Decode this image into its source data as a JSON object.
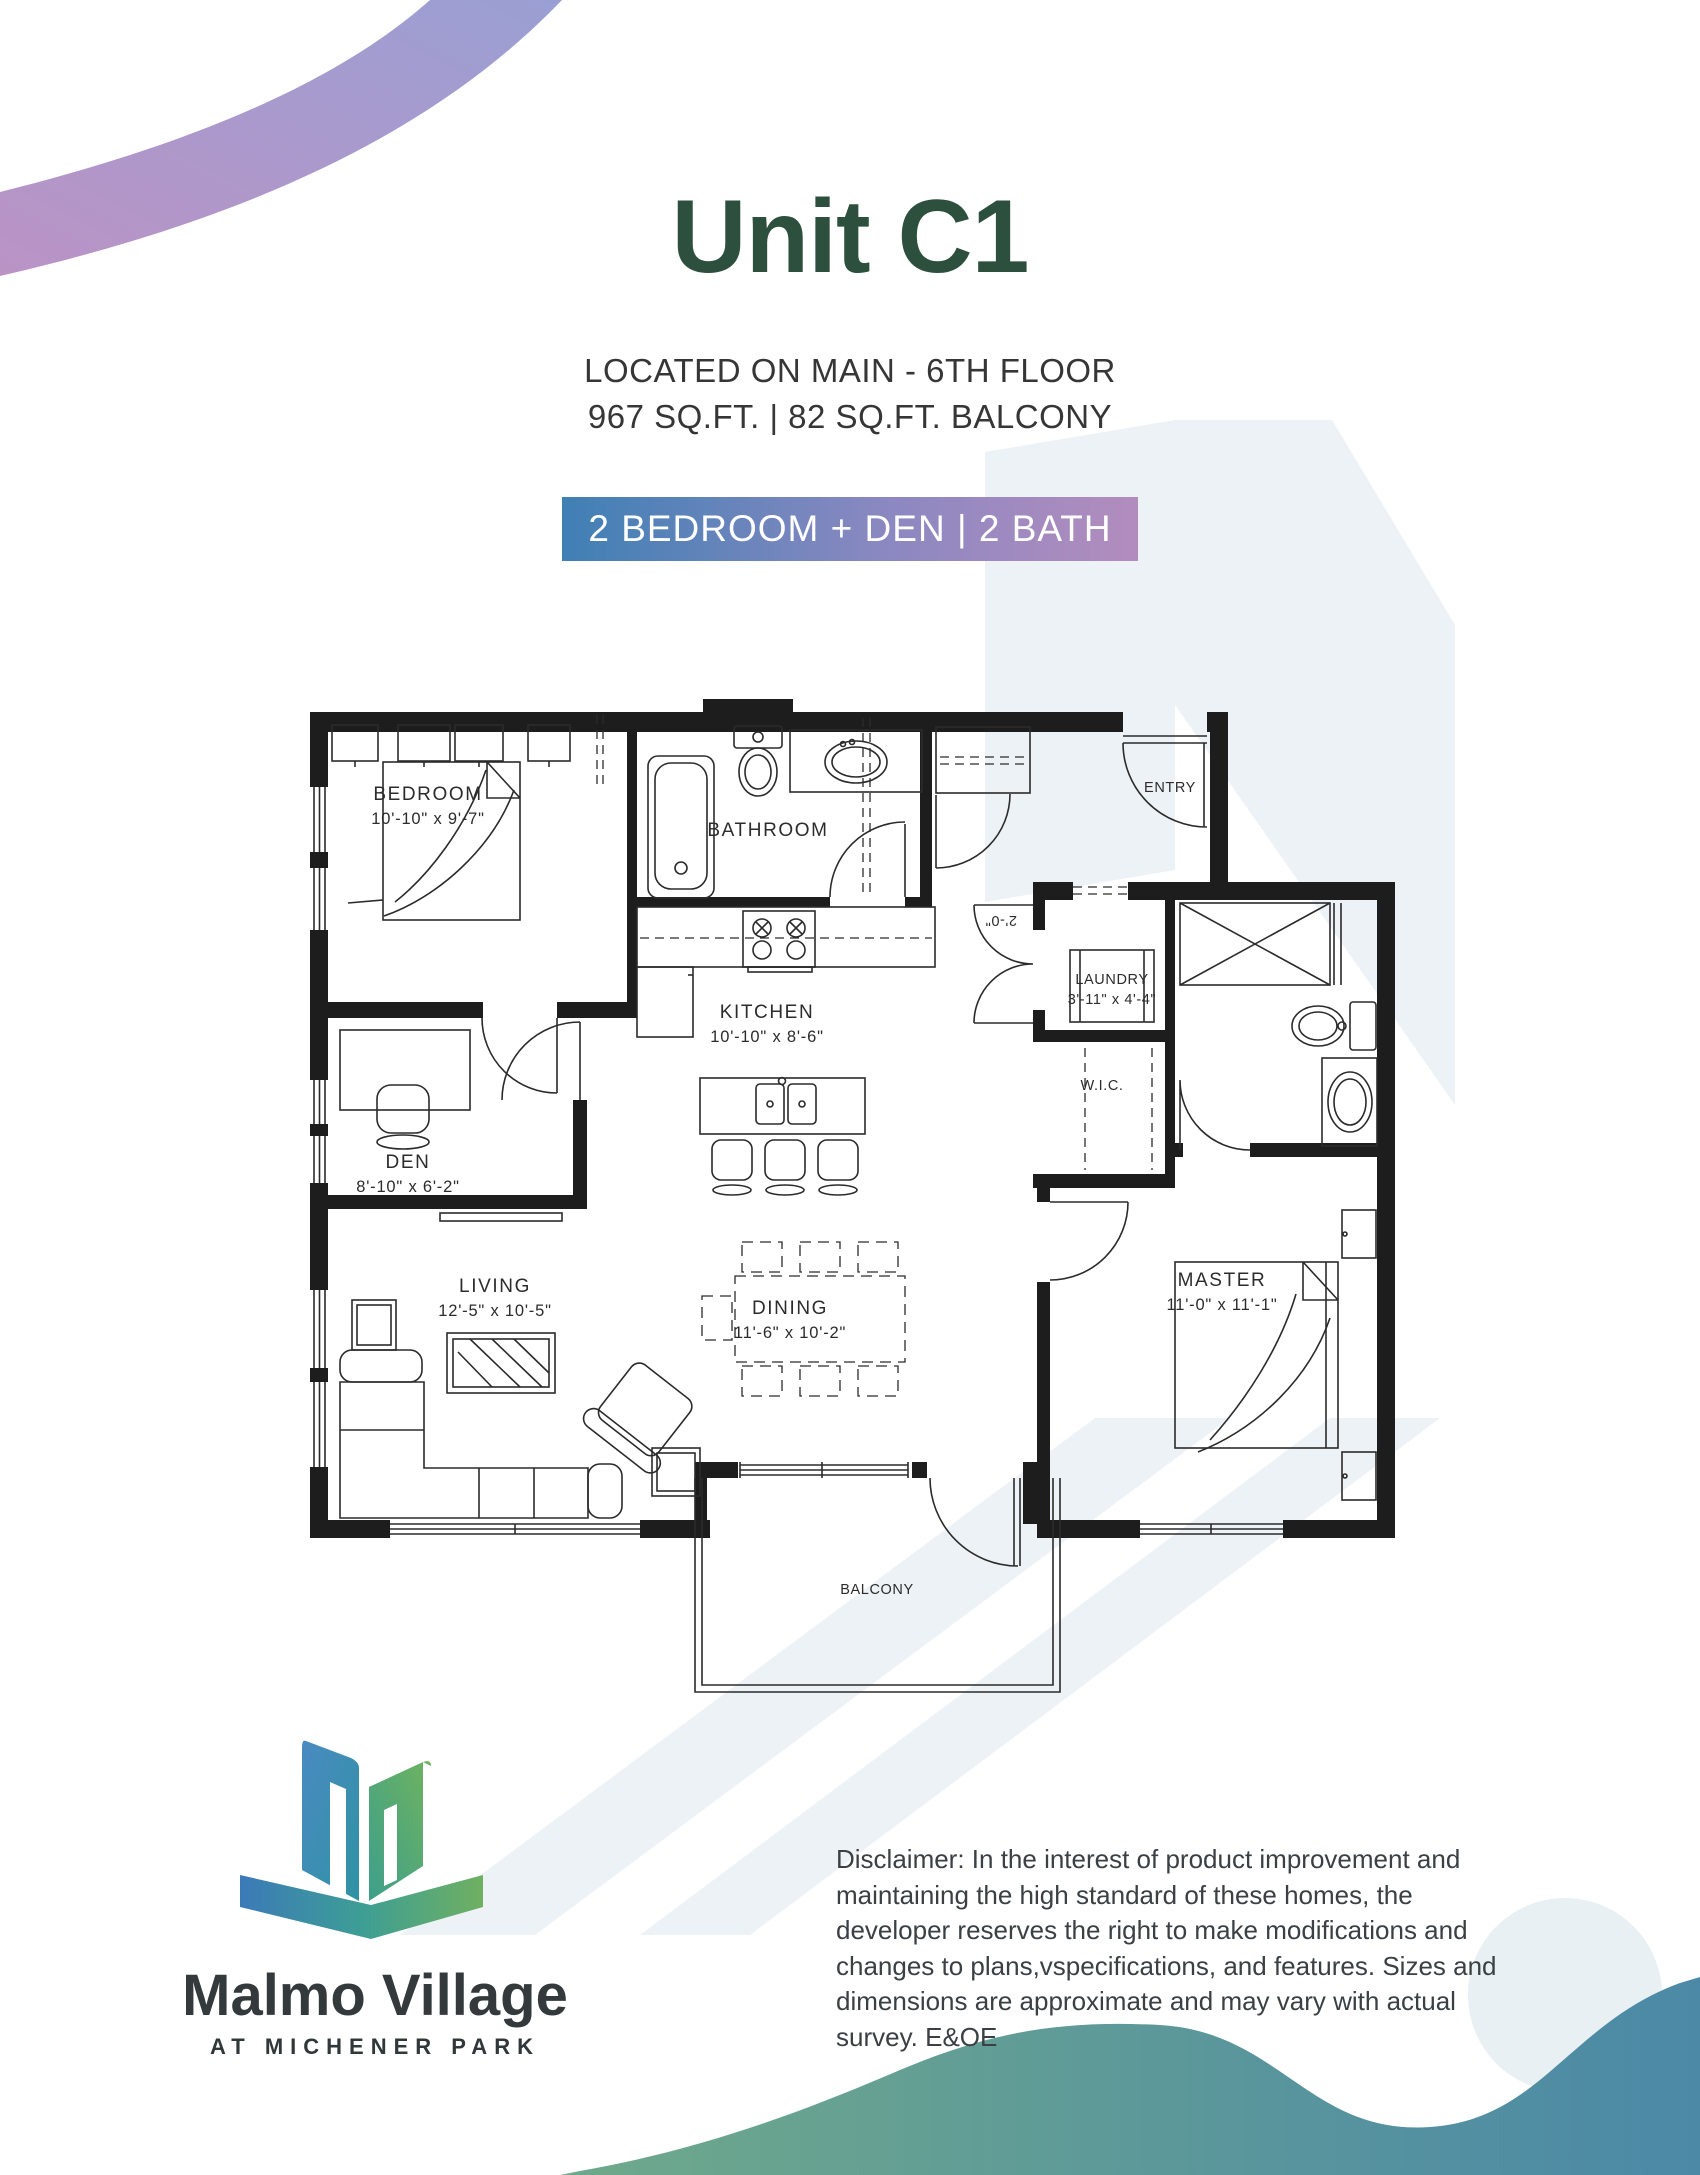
{
  "page": {
    "unit_title": "Unit C1",
    "location_line": "LOCATED ON MAIN - 6TH FLOOR",
    "area_line": "967 SQ.FT. | 82 SQ.FT. BALCONY",
    "badge_label": "2 BEDROOM + DEN | 2 BATH"
  },
  "floorplan": {
    "rooms": [
      {
        "name": "BEDROOM",
        "dims": "10'-10\" x 9'-7\""
      },
      {
        "name": "BATHROOM",
        "dims": ""
      },
      {
        "name": "KITCHEN",
        "dims": "10'-10\" x 8'-6\""
      },
      {
        "name": "DEN",
        "dims": "8'-10\" x 6'-2\""
      },
      {
        "name": "LIVING",
        "dims": "12'-5\" x 10'-5\""
      },
      {
        "name": "DINING",
        "dims": "11'-6\" x 10'-2\""
      },
      {
        "name": "ENTRY",
        "dims": ""
      },
      {
        "name": "LAUNDRY",
        "dims": "3'-11\" x 4'-4\""
      },
      {
        "name": "W.I.C.",
        "dims": ""
      },
      {
        "name": "MASTER",
        "dims": "11'-0\" x 11'-1\""
      },
      {
        "name": "BALCONY",
        "dims": ""
      }
    ],
    "door_width_label": "2'-0\""
  },
  "logo": {
    "brand": "Malmo Village",
    "tagline": "AT MICHENER PARK"
  },
  "disclaimer": "Disclaimer: In the interest of product improvement and maintaining the high standard of these homes, the developer reserves the right to make modifications and changes to plans,vspecifications, and features. Sizes and dimensions are approximate and may vary with actual survey. E&OE",
  "colors": {
    "title_green": "#2d4f3d",
    "badge_gradient_left": "#3f80b4",
    "badge_gradient_right": "#b38cbe",
    "arc_purple": "#b793c4",
    "arc_blue_purple": "#9a9ed2",
    "wave_green": "#6fa98b",
    "wave_teal": "#4b89a7",
    "watermark": "#edf2f6"
  }
}
